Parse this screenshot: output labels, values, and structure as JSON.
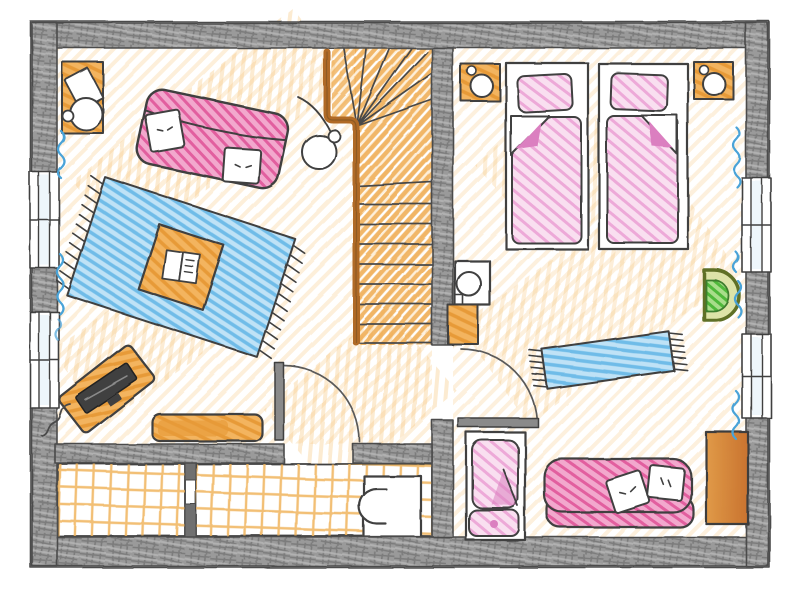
{
  "palette": {
    "outline": "#3f3f3f",
    "wall_fill": "#9a9a9a",
    "wall_hatch_dark": "#6e6e6e",
    "wall_hatch_light": "#b7b7b7",
    "floor_scribble": "#f5c47b",
    "stair_scribble": "#efab50",
    "railing_brown": "#b06a28",
    "wood_orange_base": "#f3b45f",
    "wood_orange_line": "#e79a37",
    "sofa_pink_base": "#f2a8cd",
    "sofa_pink_line": "#e25f9f",
    "bed_pink_base": "#f9dff0",
    "bed_pink_line": "#eba0d4",
    "bed_pink_fold": "#db7fc0",
    "rug_blue_base": "#bfe2f6",
    "rug_blue_line": "#6fbce8",
    "radiator_blue": "#4aa3d8",
    "plant_green_base": "#a8dd8a",
    "plant_green_line": "#4fb83a",
    "plant_ring": "#dde3a8",
    "plant_ring_stroke": "#5f6f28",
    "wardrobe_left": "#e09a48",
    "wardrobe_right": "#c9732f",
    "tv_screen": "#404040",
    "tile_grid": "#f0b45c",
    "window_glass": "#eef6fb",
    "door_leaf": "#8a8a8a",
    "paper_white": "#ffffff"
  },
  "counts": {
    "stair_treads": 9,
    "windows_left_wall": 2,
    "windows_right_wall": 2,
    "radiator_squiggles": 7,
    "single_beds": 2,
    "bed_pillows": 2,
    "daybed_pillows": 2,
    "sofa_cushions": 2,
    "nightstands": 2,
    "storage_compartments": 2
  },
  "rooms": [
    {
      "name": "living-room",
      "items": [
        "desk-with-chair",
        "sofa",
        "floor-lamp",
        "area-rug",
        "coffee-table",
        "open-book",
        "tv-on-stand",
        "sideboard"
      ]
    },
    {
      "name": "stair-hall",
      "items": [
        "winder-staircase",
        "stair-railing",
        "door-to-storage"
      ]
    },
    {
      "name": "bedroom",
      "items": [
        "nightstand-left",
        "single-bed-left",
        "single-bed-right",
        "nightstand-right",
        "side-table-with-lamp",
        "small-cabinet",
        "runner-rug",
        "green-semicircle-basin",
        "wardrobe",
        "crib",
        "daybed",
        "bedroom-door"
      ]
    },
    {
      "name": "storage-left",
      "items": [
        "tiled-floor"
      ]
    },
    {
      "name": "storage-right",
      "items": [
        "tiled-floor",
        "washing-machine"
      ]
    }
  ]
}
